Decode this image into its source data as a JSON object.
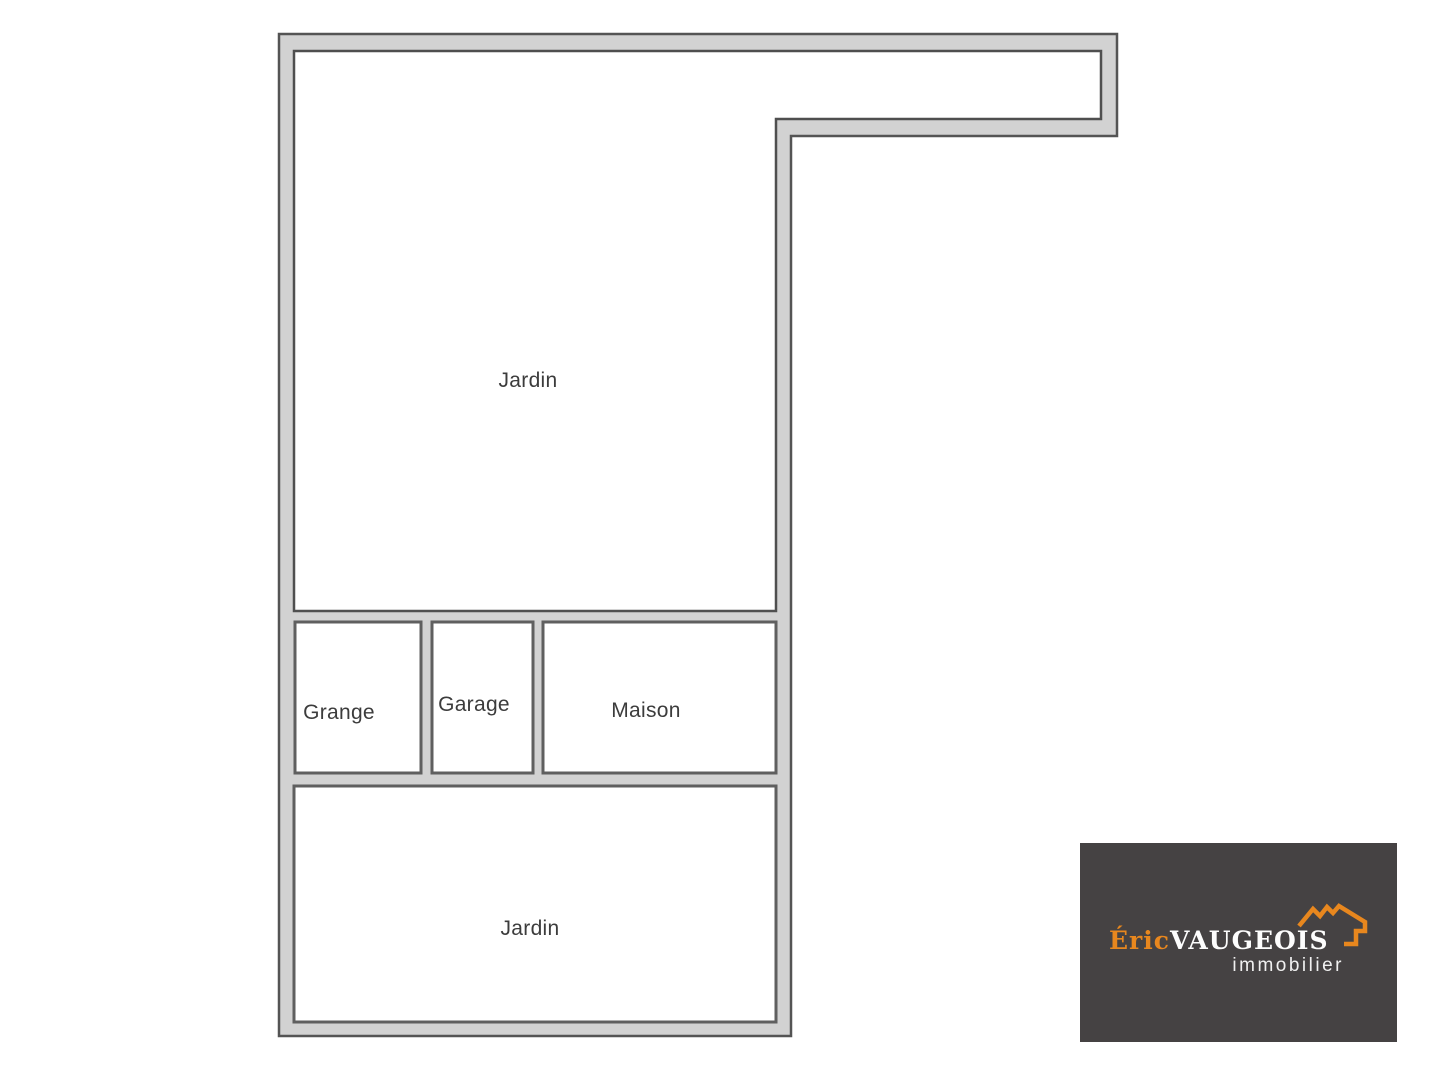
{
  "plan": {
    "rooms": {
      "jardin_top": "Jardin",
      "grange": "Grange",
      "garage": "Garage",
      "maison": "Maison",
      "jardin_bottom": "Jardin"
    },
    "colors": {
      "wall_fill": "#d2d2d2",
      "wall_line": "#545454",
      "room_fill": "#ffffff",
      "label_color": "#3c3c3c"
    }
  },
  "logo": {
    "brand_first": "Éric",
    "brand_last": "VAUGEOIS",
    "tagline": "immobilier",
    "colors": {
      "background": "#454243",
      "orange": "#e8871e",
      "white": "#fdfdfd"
    }
  }
}
